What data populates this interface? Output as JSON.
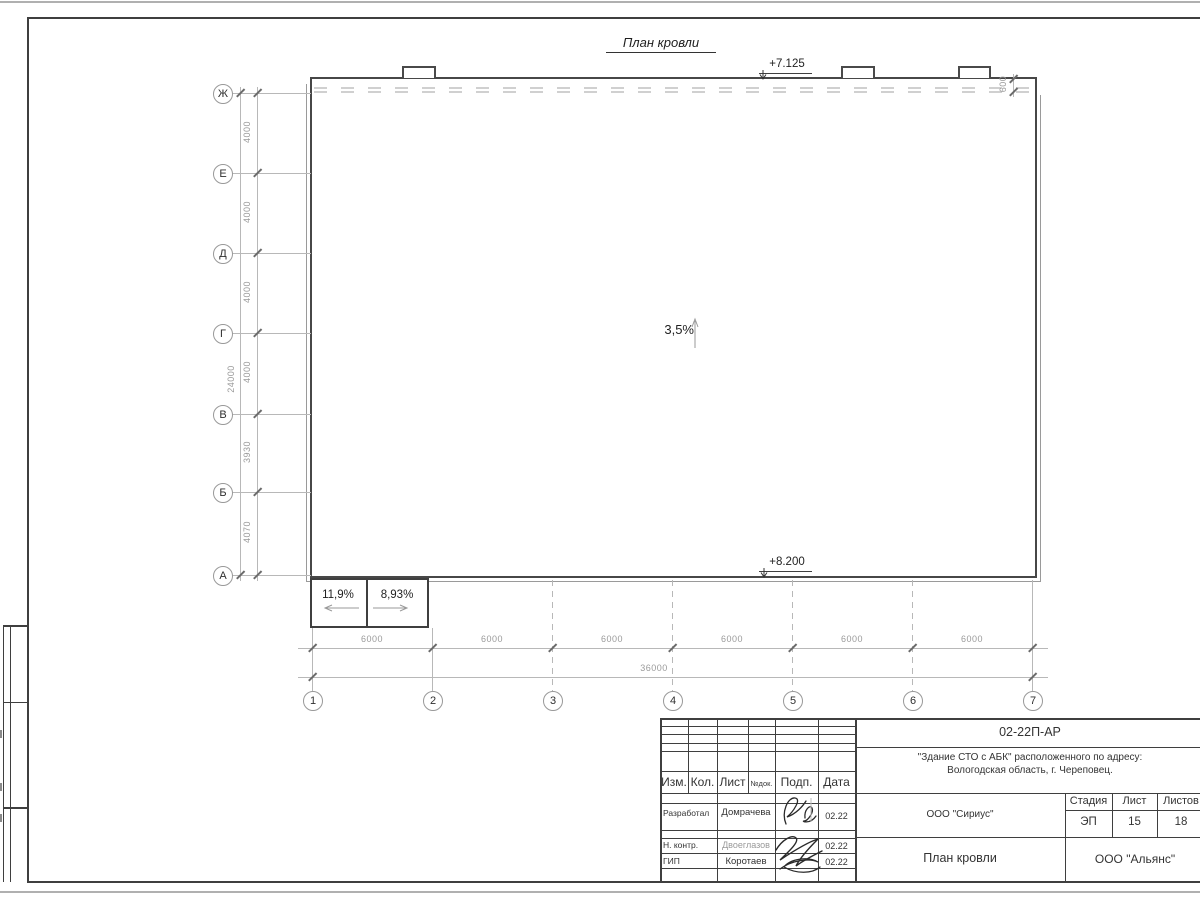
{
  "drawing": {
    "title": "План кровли",
    "slope": "3,5%",
    "elev_top": "+7.125",
    "elev_bottom": "+8.200",
    "parapet_offset": "600",
    "ramp_left": "11,9%",
    "ramp_right": "8,93%"
  },
  "axes": {
    "rows": [
      "Ж",
      "Е",
      "Д",
      "Г",
      "В",
      "Б",
      "А"
    ],
    "cols": [
      "1",
      "2",
      "3",
      "4",
      "5",
      "6",
      "7"
    ]
  },
  "dims": {
    "left": [
      "4000",
      "4000",
      "4000",
      "4000",
      "3930",
      "4070"
    ],
    "left_total": "24000",
    "bottom": [
      "6000",
      "6000",
      "6000",
      "6000",
      "6000",
      "6000"
    ],
    "bottom_total": "36000"
  },
  "titleblock": {
    "doc_number": "02-22П-АР",
    "project_line1": "\"Здание СТО с АБК\" расположенного по адресу:",
    "project_line2": "Вологодская область, г. Череповец.",
    "header": {
      "izm": "Изм.",
      "kol": "Кол.",
      "list": "Лист",
      "ndok": "№док.",
      "podp": "Подп.",
      "data": "Дата"
    },
    "rows": [
      {
        "role": "Разработал",
        "name": "Домрачева",
        "date": "02.22"
      },
      {
        "role": "Н. контр.",
        "name": "Двоеглазов",
        "date": "02.22"
      },
      {
        "role": "ГИП",
        "name": "Коротаев",
        "date": "02.22"
      }
    ],
    "org1": "ООО \"Сириус\"",
    "org2": "ООО \"Альянс\"",
    "sheet_title": "План кровли",
    "stage_label": "Стадия",
    "stage": "ЭП",
    "sheet_label": "Лист",
    "sheet": "15",
    "total_label": "Листов",
    "total": "18"
  },
  "colors": {
    "line_dark": "#3f3f3f",
    "line_gray": "#b8b8b8",
    "dim_text": "#9a9a9a",
    "muted_name": "#999999"
  }
}
